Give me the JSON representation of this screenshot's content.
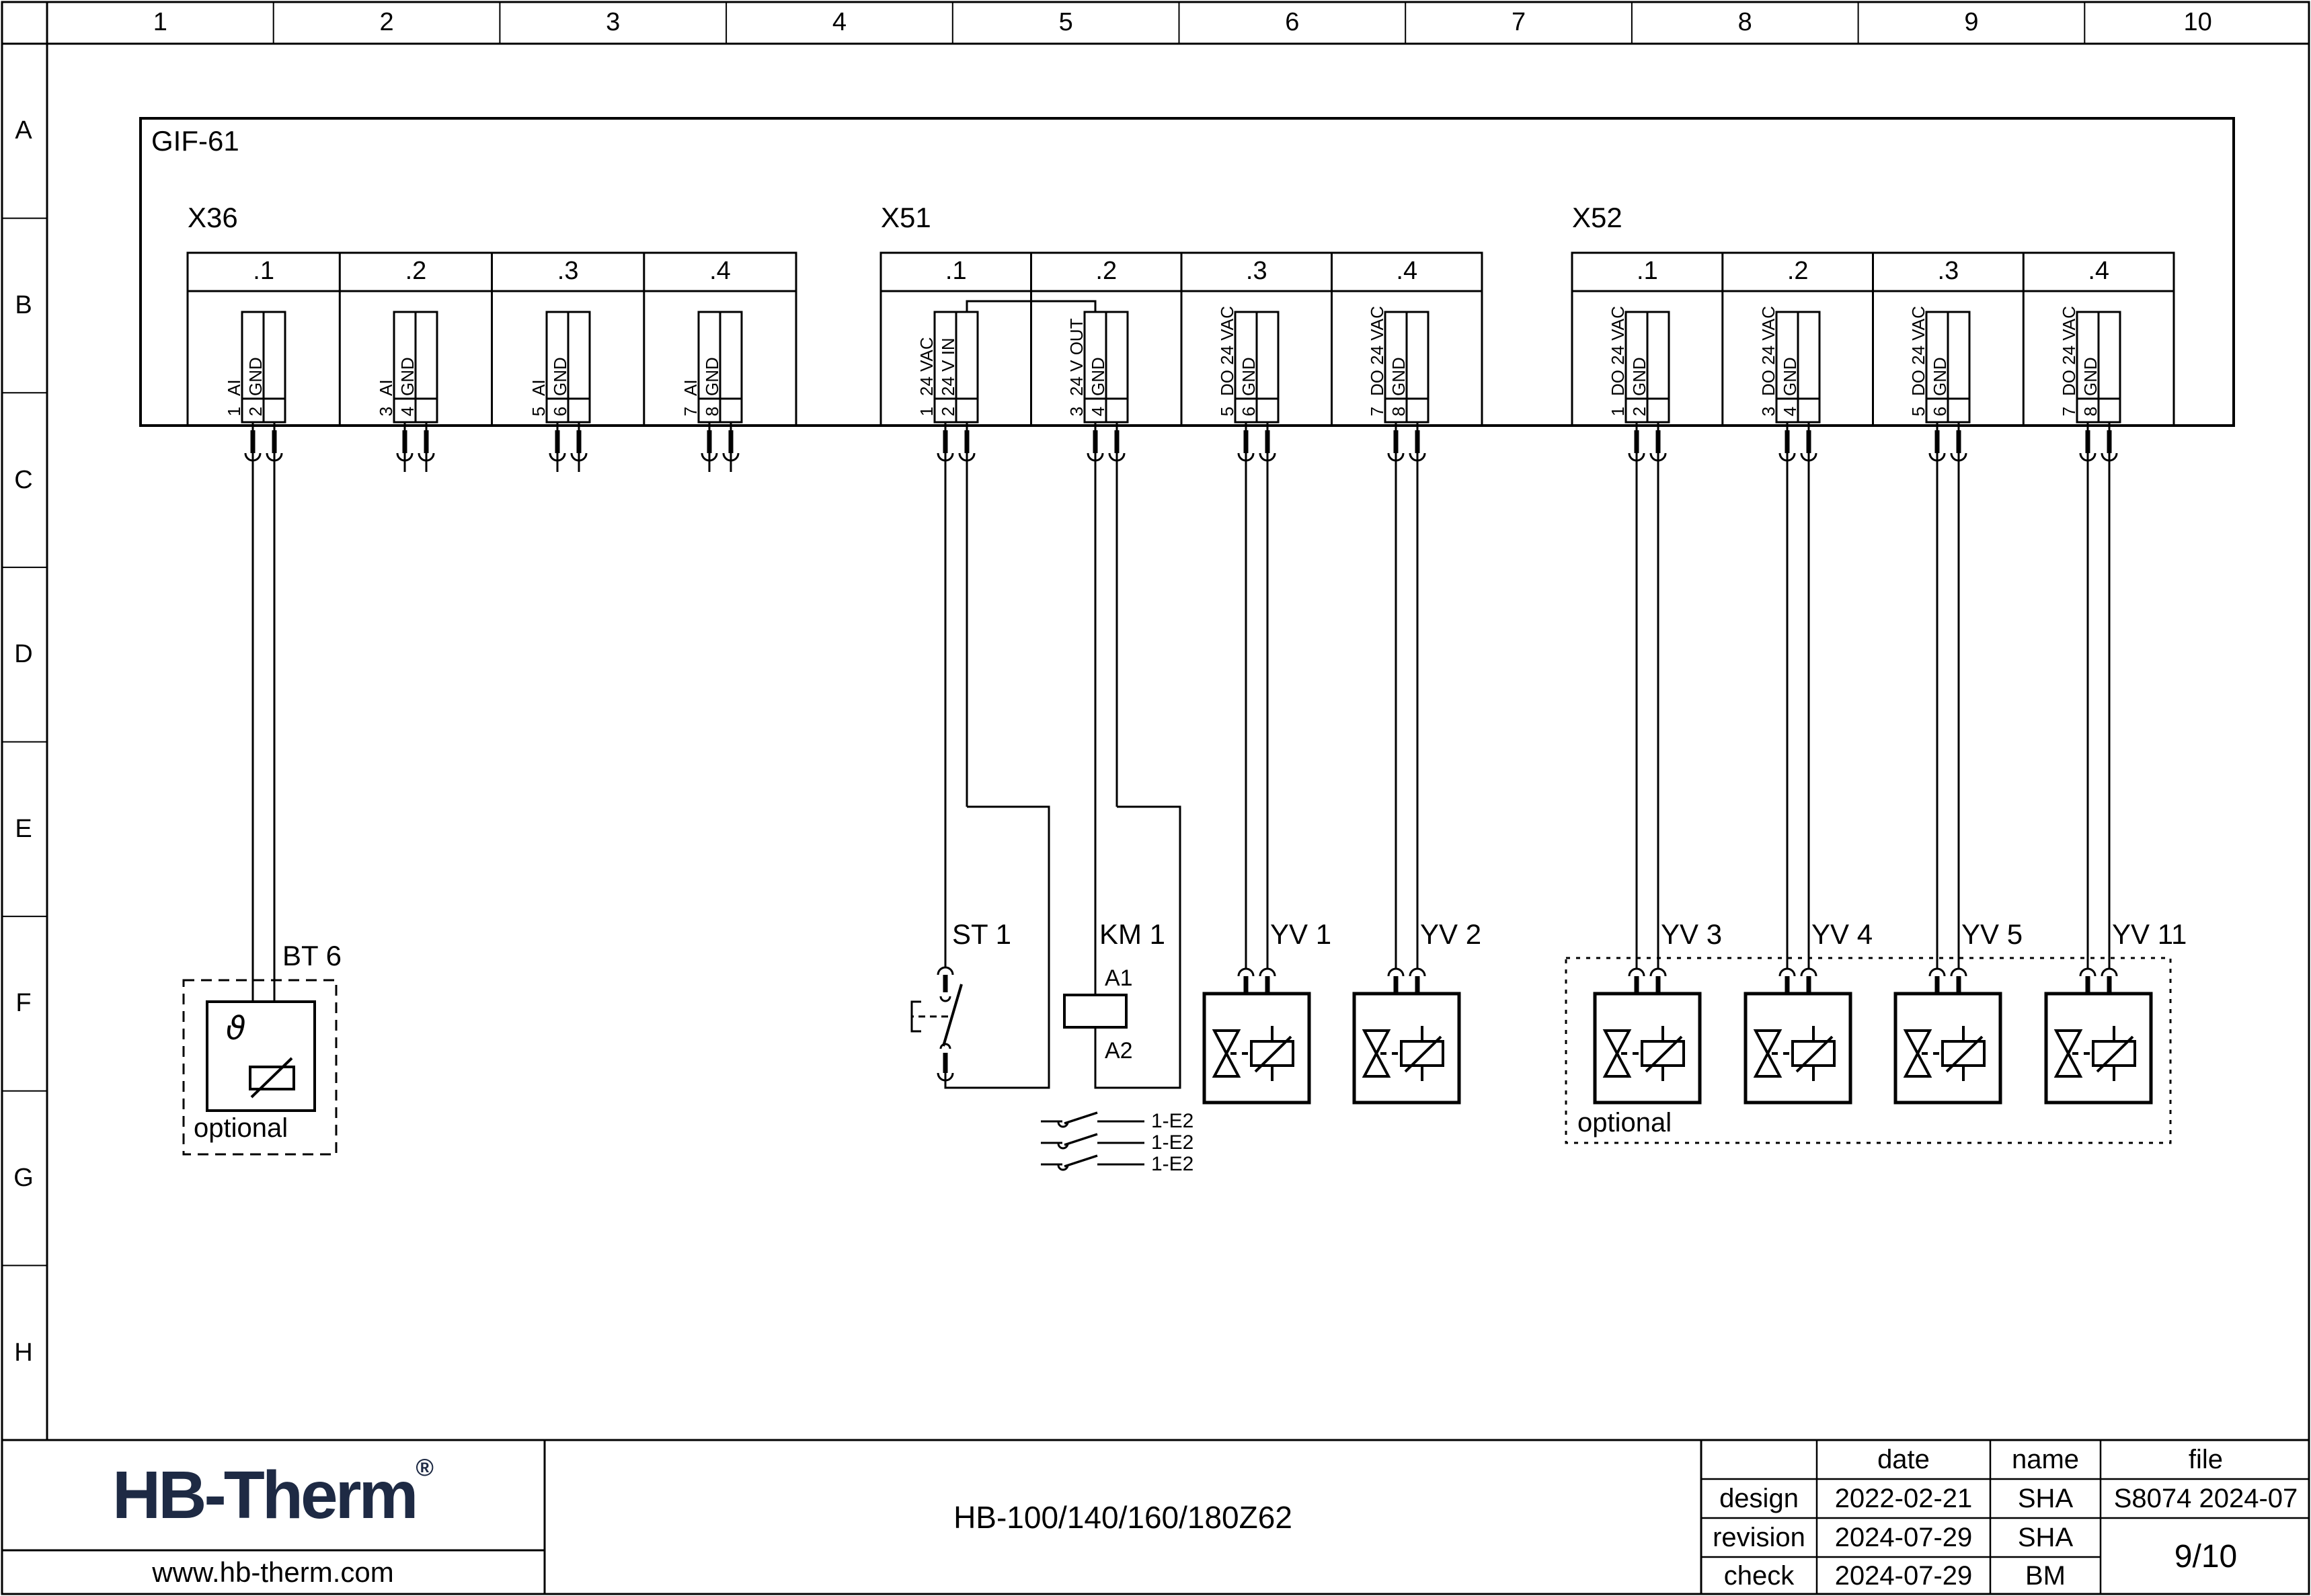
{
  "drawing": {
    "module_label": "GIF-61",
    "ruler": {
      "columns": [
        "1",
        "2",
        "3",
        "4",
        "5",
        "6",
        "7",
        "8",
        "9",
        "10"
      ],
      "rows": [
        "A",
        "B",
        "C",
        "D",
        "E",
        "F",
        "G",
        "H"
      ]
    },
    "connectors": [
      {
        "label": "X36",
        "sections": [
          {
            "label": ".1",
            "terminals": [
              {
                "pin": "1",
                "signal": "AI"
              },
              {
                "pin": "2",
                "signal": "GND"
              }
            ]
          },
          {
            "label": ".2",
            "terminals": [
              {
                "pin": "3",
                "signal": "AI"
              },
              {
                "pin": "4",
                "signal": "GND"
              }
            ]
          },
          {
            "label": ".3",
            "terminals": [
              {
                "pin": "5",
                "signal": "AI"
              },
              {
                "pin": "6",
                "signal": "GND"
              }
            ]
          },
          {
            "label": ".4",
            "terminals": [
              {
                "pin": "7",
                "signal": "AI"
              },
              {
                "pin": "8",
                "signal": "GND"
              }
            ]
          }
        ]
      },
      {
        "label": "X51",
        "sections": [
          {
            "label": ".1",
            "terminals": [
              {
                "pin": "1",
                "signal": "24 VAC"
              },
              {
                "pin": "2",
                "signal": "24 V IN"
              }
            ]
          },
          {
            "label": ".2",
            "terminals": [
              {
                "pin": "3",
                "signal": "24 V OUT"
              },
              {
                "pin": "4",
                "signal": "GND"
              }
            ]
          },
          {
            "label": ".3",
            "terminals": [
              {
                "pin": "5",
                "signal": "DO 24 VAC"
              },
              {
                "pin": "6",
                "signal": "GND"
              }
            ]
          },
          {
            "label": ".4",
            "terminals": [
              {
                "pin": "7",
                "signal": "DO 24 VAC"
              },
              {
                "pin": "8",
                "signal": "GND"
              }
            ]
          }
        ]
      },
      {
        "label": "X52",
        "sections": [
          {
            "label": ".1",
            "terminals": [
              {
                "pin": "1",
                "signal": "DO 24 VAC"
              },
              {
                "pin": "2",
                "signal": "GND"
              }
            ]
          },
          {
            "label": ".2",
            "terminals": [
              {
                "pin": "3",
                "signal": "DO 24 VAC"
              },
              {
                "pin": "4",
                "signal": "GND"
              }
            ]
          },
          {
            "label": ".3",
            "terminals": [
              {
                "pin": "5",
                "signal": "DO 24 VAC"
              },
              {
                "pin": "6",
                "signal": "GND"
              }
            ]
          },
          {
            "label": ".4",
            "terminals": [
              {
                "pin": "7",
                "signal": "DO 24 VAC"
              },
              {
                "pin": "8",
                "signal": "GND"
              }
            ]
          }
        ]
      }
    ],
    "components": {
      "bt6": {
        "label": "BT 6",
        "symbol_letter": "ϑ",
        "note": "optional"
      },
      "st1": {
        "label": "ST 1"
      },
      "km1": {
        "label": "KM 1",
        "coil_top": "A1",
        "coil_bottom": "A2"
      },
      "interlock_contacts": [
        {
          "label": "1-E2"
        },
        {
          "label": "1-E2"
        },
        {
          "label": "1-E2"
        }
      ],
      "valves": [
        {
          "label": "YV 1"
        },
        {
          "label": "YV 2"
        },
        {
          "label": "YV 3"
        },
        {
          "label": "YV 4"
        },
        {
          "label": "YV 5"
        },
        {
          "label": "YV 11"
        }
      ],
      "optional_group_label": "optional"
    }
  },
  "title_block": {
    "logo_text": "HB-Therm",
    "logo_reg": "®",
    "website": "www.hb-therm.com",
    "drawing_title": "HB-100/140/160/180Z62",
    "table": {
      "headers": {
        "date": "date",
        "name": "name",
        "file": "file"
      },
      "rows": [
        {
          "label": "design",
          "date": "2022-02-21",
          "name": "SHA"
        },
        {
          "label": "revision",
          "date": "2024-07-29",
          "name": "SHA"
        },
        {
          "label": "check",
          "date": "2024-07-29",
          "name": "BM"
        }
      ],
      "file_value": "S8074 2024-07",
      "page": "9/10"
    }
  },
  "colors": {
    "line": "#000000",
    "logo_navy": "#1e2a44",
    "background": "#ffffff"
  }
}
